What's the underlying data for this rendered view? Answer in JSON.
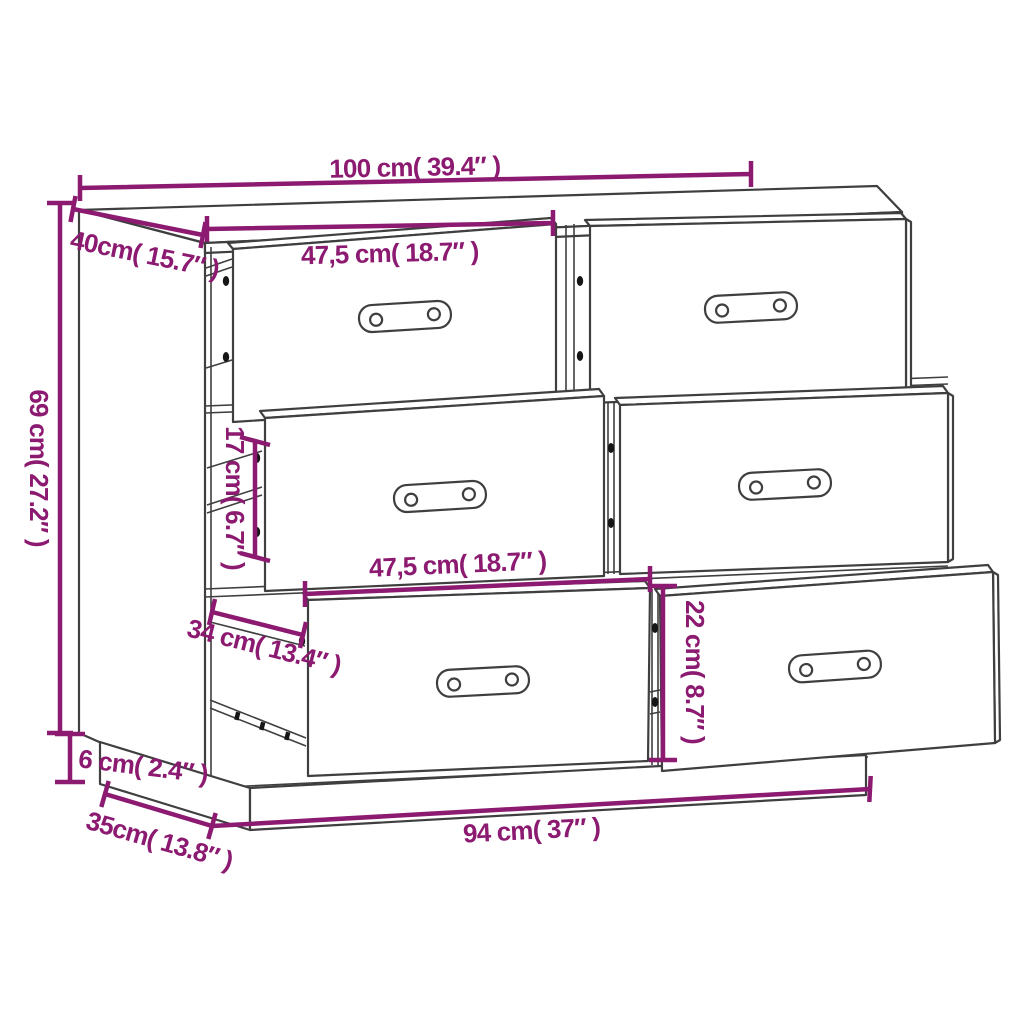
{
  "colors": {
    "accent": "#8b1a70",
    "outline": "#3f3f3f",
    "background": "#ffffff",
    "hardware": "#161616"
  },
  "dimensions": {
    "top_width": "100 cm( 39.4″ )",
    "top_depth": "40cm( 15.7″ )",
    "height": "69 cm( 27.2″ )",
    "top_drawer_width": "47,5 cm( 18.7″ )",
    "inner_height": "17 cm( 6.7″ )",
    "middle_drawer_width": "47,5 cm( 18.7″ )",
    "slide_depth": "34 cm( 13.4″ )",
    "bottom_drawer_height": "22 cm( 8.7″ )",
    "plinth_height": "6 cm( 2.4″ )",
    "base_depth": "35cm( 13.8″ )",
    "base_width": "94 cm( 37″ )"
  }
}
